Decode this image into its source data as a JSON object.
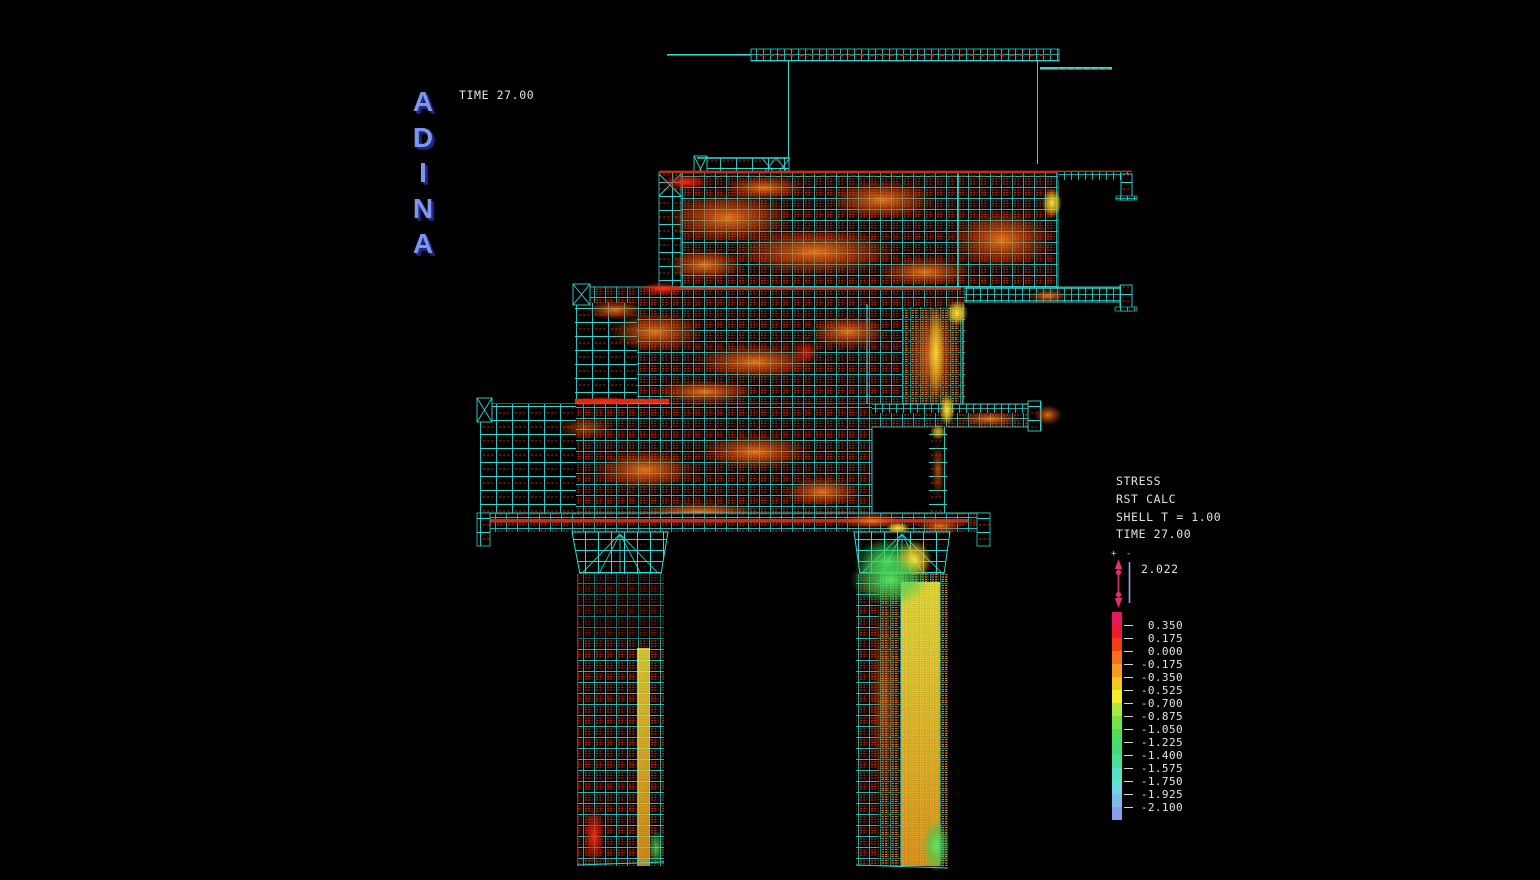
{
  "app": {
    "logo": "ADINA",
    "time_label": "TIME 27.00"
  },
  "legend": {
    "lines": [
      "STRESS",
      "RST CALC",
      "SHELL T = 1.00",
      "TIME 27.00"
    ]
  },
  "max_marker": {
    "signs": "+ -",
    "value": "2.022"
  },
  "color_scale": {
    "band_colors": [
      "#e8175d",
      "#ec1c24",
      "#f03d18",
      "#f4701a",
      "#f89c1e",
      "#f2c822",
      "#f2ee2e",
      "#aee83c",
      "#72e44a",
      "#4ce05c",
      "#44dc74",
      "#48e09a",
      "#54e4c2",
      "#6cd8e4",
      "#7cbcec",
      "#8c9cec"
    ],
    "tick_labels": [
      "0.350",
      "0.175",
      "0.000",
      "-0.175",
      "-0.350",
      "-0.525",
      "-0.700",
      "-0.875",
      "-1.050",
      "-1.225",
      "-1.400",
      "-1.575",
      "-1.750",
      "-1.925",
      "-2.100"
    ]
  },
  "colors": {
    "background": "#000000",
    "mesh_line_cyan": "#2fd8d2",
    "element_red": "#c22808",
    "logo_blue": "#7d95ee",
    "text_white": "#e2e2e2",
    "marker_pink": "#e0336e",
    "marker_blue": "#86a8e0"
  }
}
